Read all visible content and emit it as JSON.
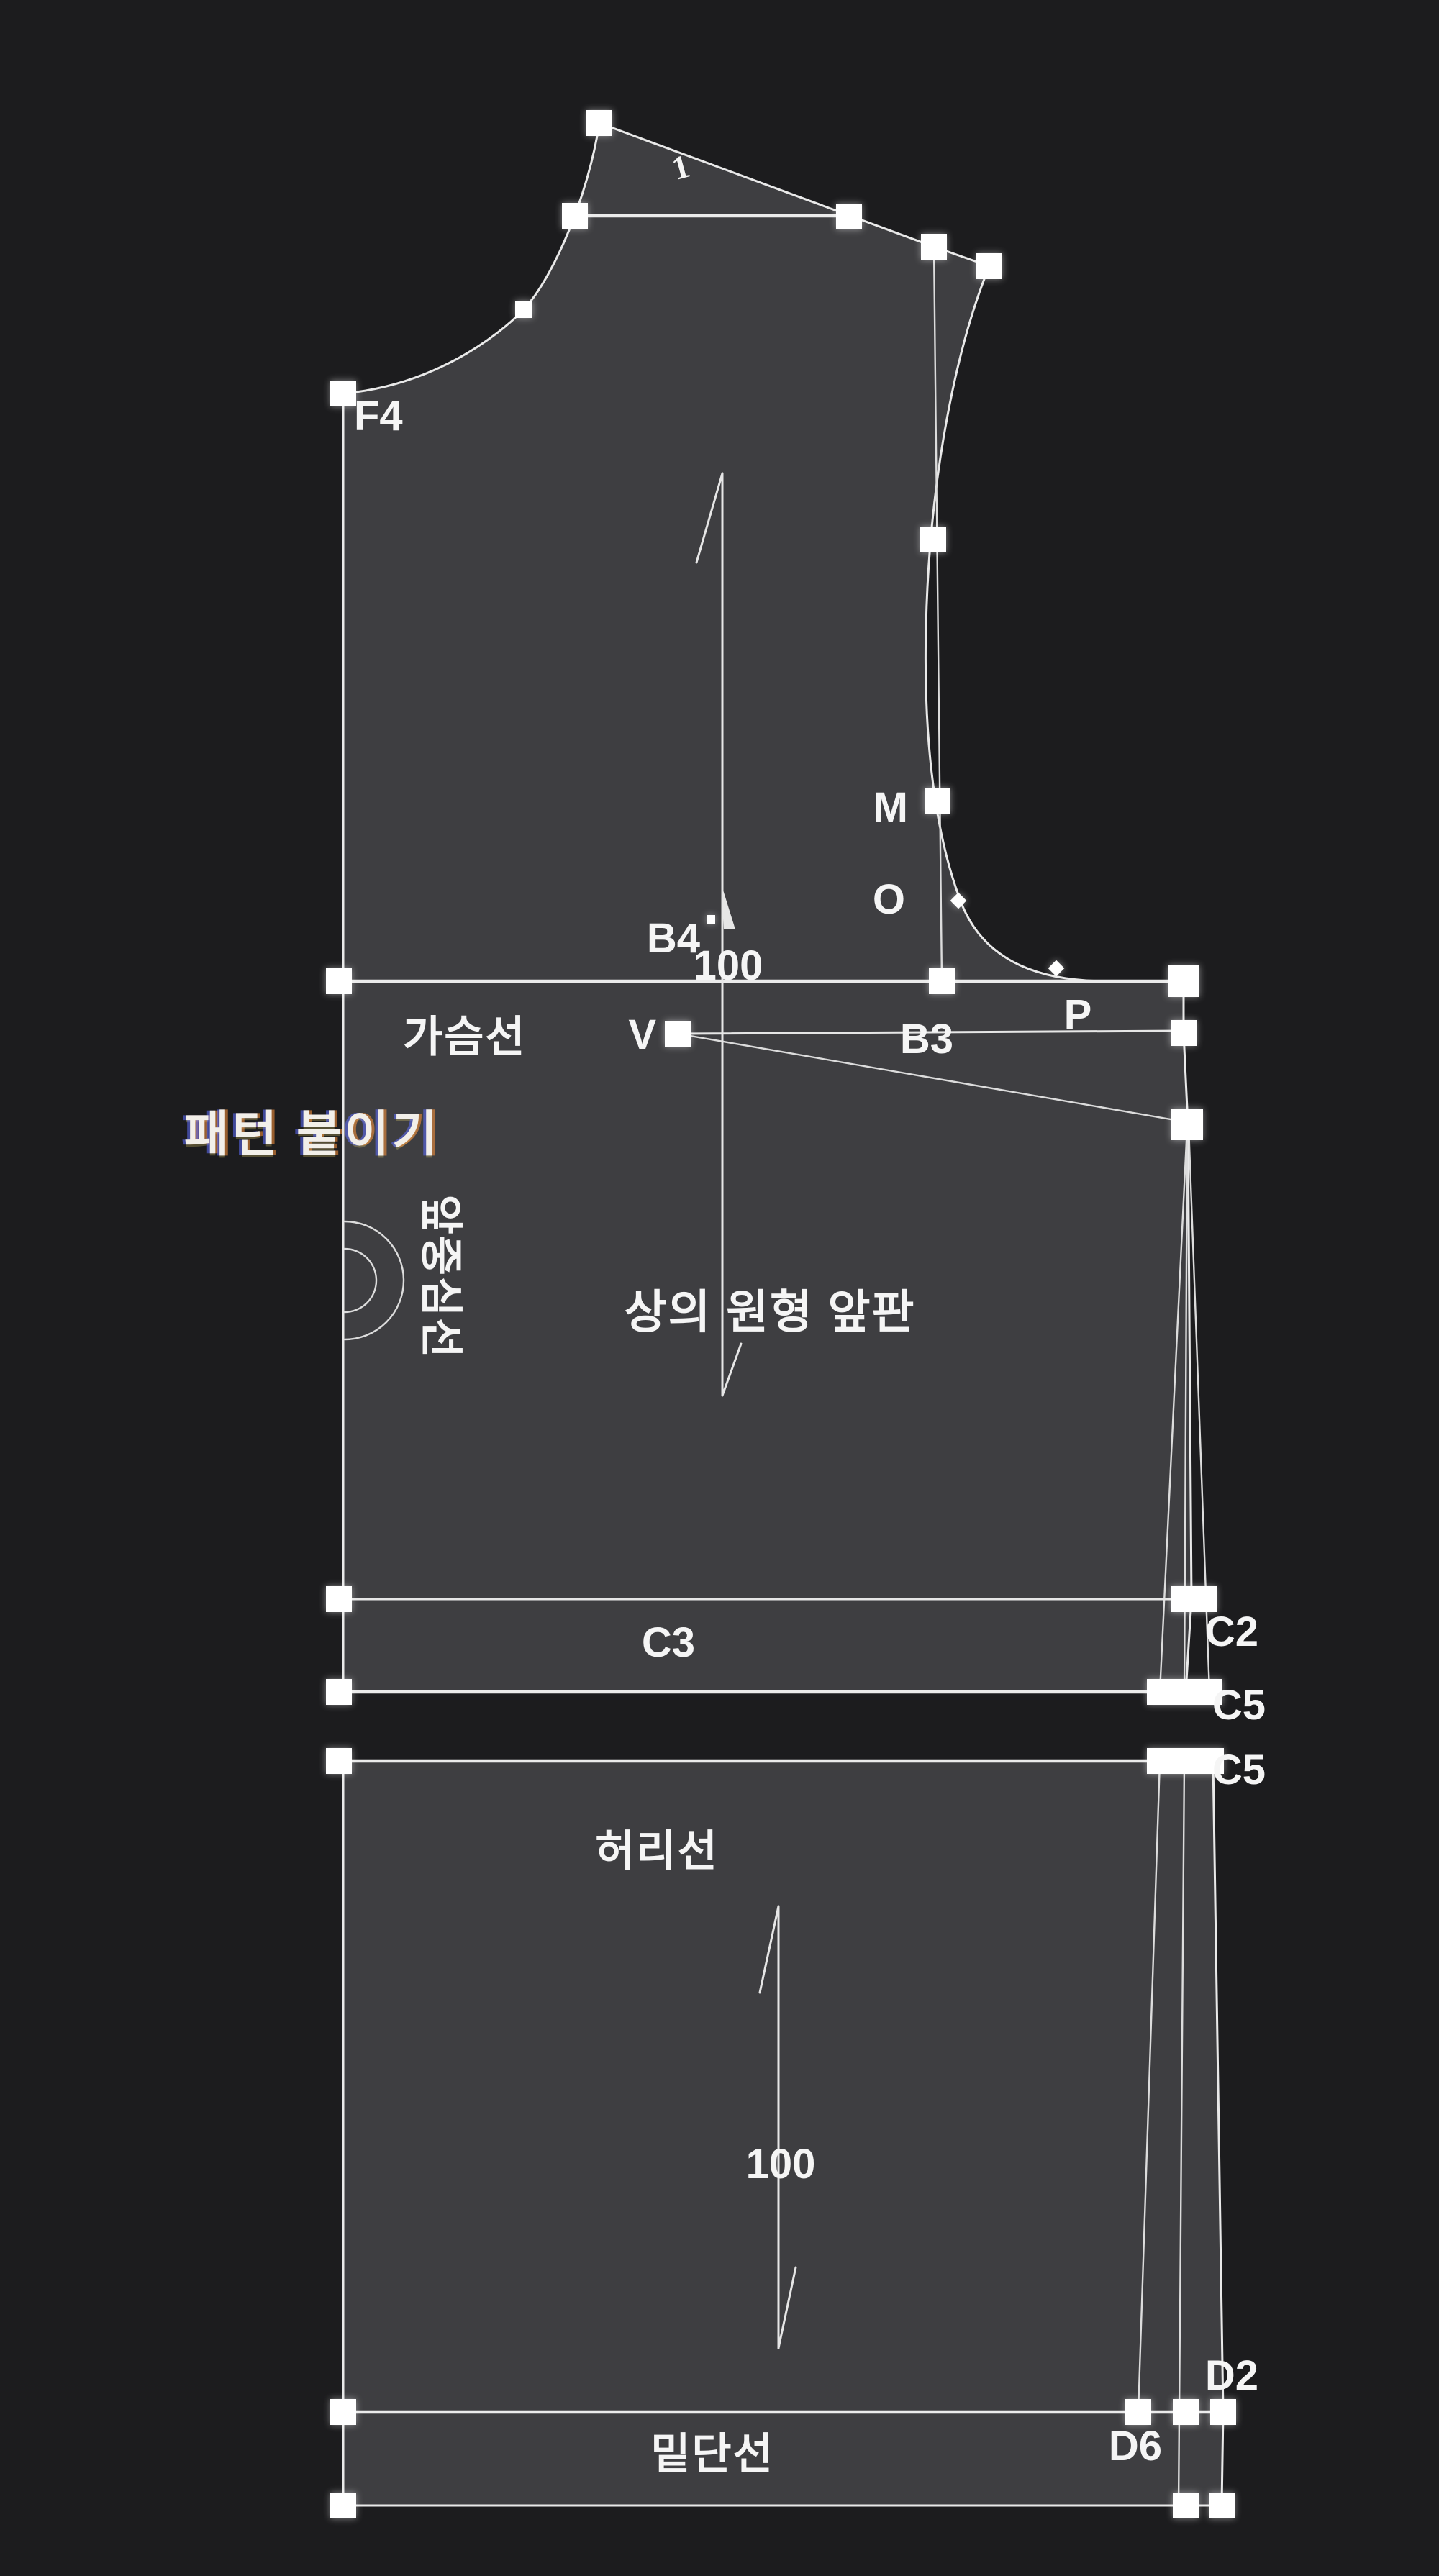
{
  "colors": {
    "background": "#1c1c1e",
    "piece_fill": "#3e3e41",
    "line": "#e9e9e9",
    "handle": "#ffffff",
    "text": "#f5f5f5"
  },
  "floating_label": {
    "text": "패턴 붙이기"
  },
  "piece": {
    "title": "상의 원형 앞판"
  },
  "guide_line_labels": {
    "chest_line": "가슴선",
    "waist_line": "허리선",
    "hem_line": "밑단선",
    "center_front": "앞중심선"
  },
  "point_labels": {
    "f4": "F4",
    "b4": "B4",
    "b3": "B3",
    "m": "M",
    "o": "O",
    "p": "P",
    "v": "V",
    "c3": "C3",
    "c2": "C2",
    "c5_upper": "C5",
    "c5_lower": "C5",
    "d2": "D2",
    "d6": "D6"
  },
  "dimensions": {
    "grainline_upper": "100",
    "grainline_lower": "100",
    "shoulder_notch": "1"
  }
}
